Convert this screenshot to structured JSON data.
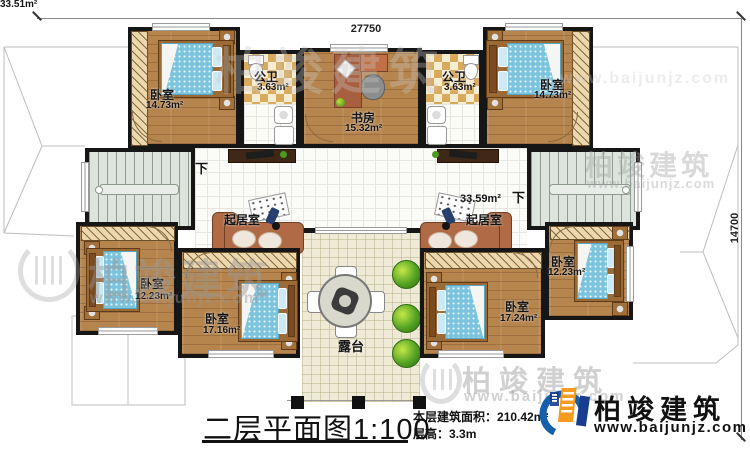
{
  "dimensions": {
    "top": "27750",
    "right": "14700"
  },
  "rooms": {
    "bedroom_tl": {
      "name": "卧室",
      "area": "14.73m²"
    },
    "bedroom_tr": {
      "name": "卧室",
      "area": "14.73m²"
    },
    "bath_left": {
      "name": "公卫",
      "area": "3.63m²"
    },
    "bath_right": {
      "name": "公卫",
      "area": "3.63m²"
    },
    "study": {
      "name": "书房",
      "area": "15.32m²"
    },
    "living_left": {
      "name": "起居室",
      "area": "33.51m²"
    },
    "living_right": {
      "name": "起居室",
      "area": "33.59m²"
    },
    "bedroom_bl": {
      "name": "卧室",
      "area": "12.23m²"
    },
    "bedroom_bcl": {
      "name": "卧室",
      "area": "17.16m²"
    },
    "bedroom_bcr": {
      "name": "卧室",
      "area": "17.24m²"
    },
    "bedroom_br": {
      "name": "卧室",
      "area": "12.23m²"
    },
    "terrace": {
      "name": "露台"
    }
  },
  "stairs": {
    "down_left": "下",
    "down_right": "下"
  },
  "titleblock": {
    "title": "二层平面图1:100",
    "area_label": "本层建筑面积：",
    "area_value": "210.42m²",
    "floor_height_label": "层高：",
    "floor_height_value": "3.3m"
  },
  "brand": {
    "name": "柏竣建筑",
    "url": "www.baijunjz.com"
  },
  "watermark": {
    "name": "柏竣建筑",
    "url": "www.baijunjz.com"
  },
  "colors": {
    "wall": "#161616",
    "wood_floor": "#b6854e",
    "bed_blue": "#7cc4de",
    "terrace_floor": "#efead6",
    "checker_tan": "#d9a95e",
    "logo_blue": "#1460ac",
    "logo_orange": "#f59b20"
  }
}
